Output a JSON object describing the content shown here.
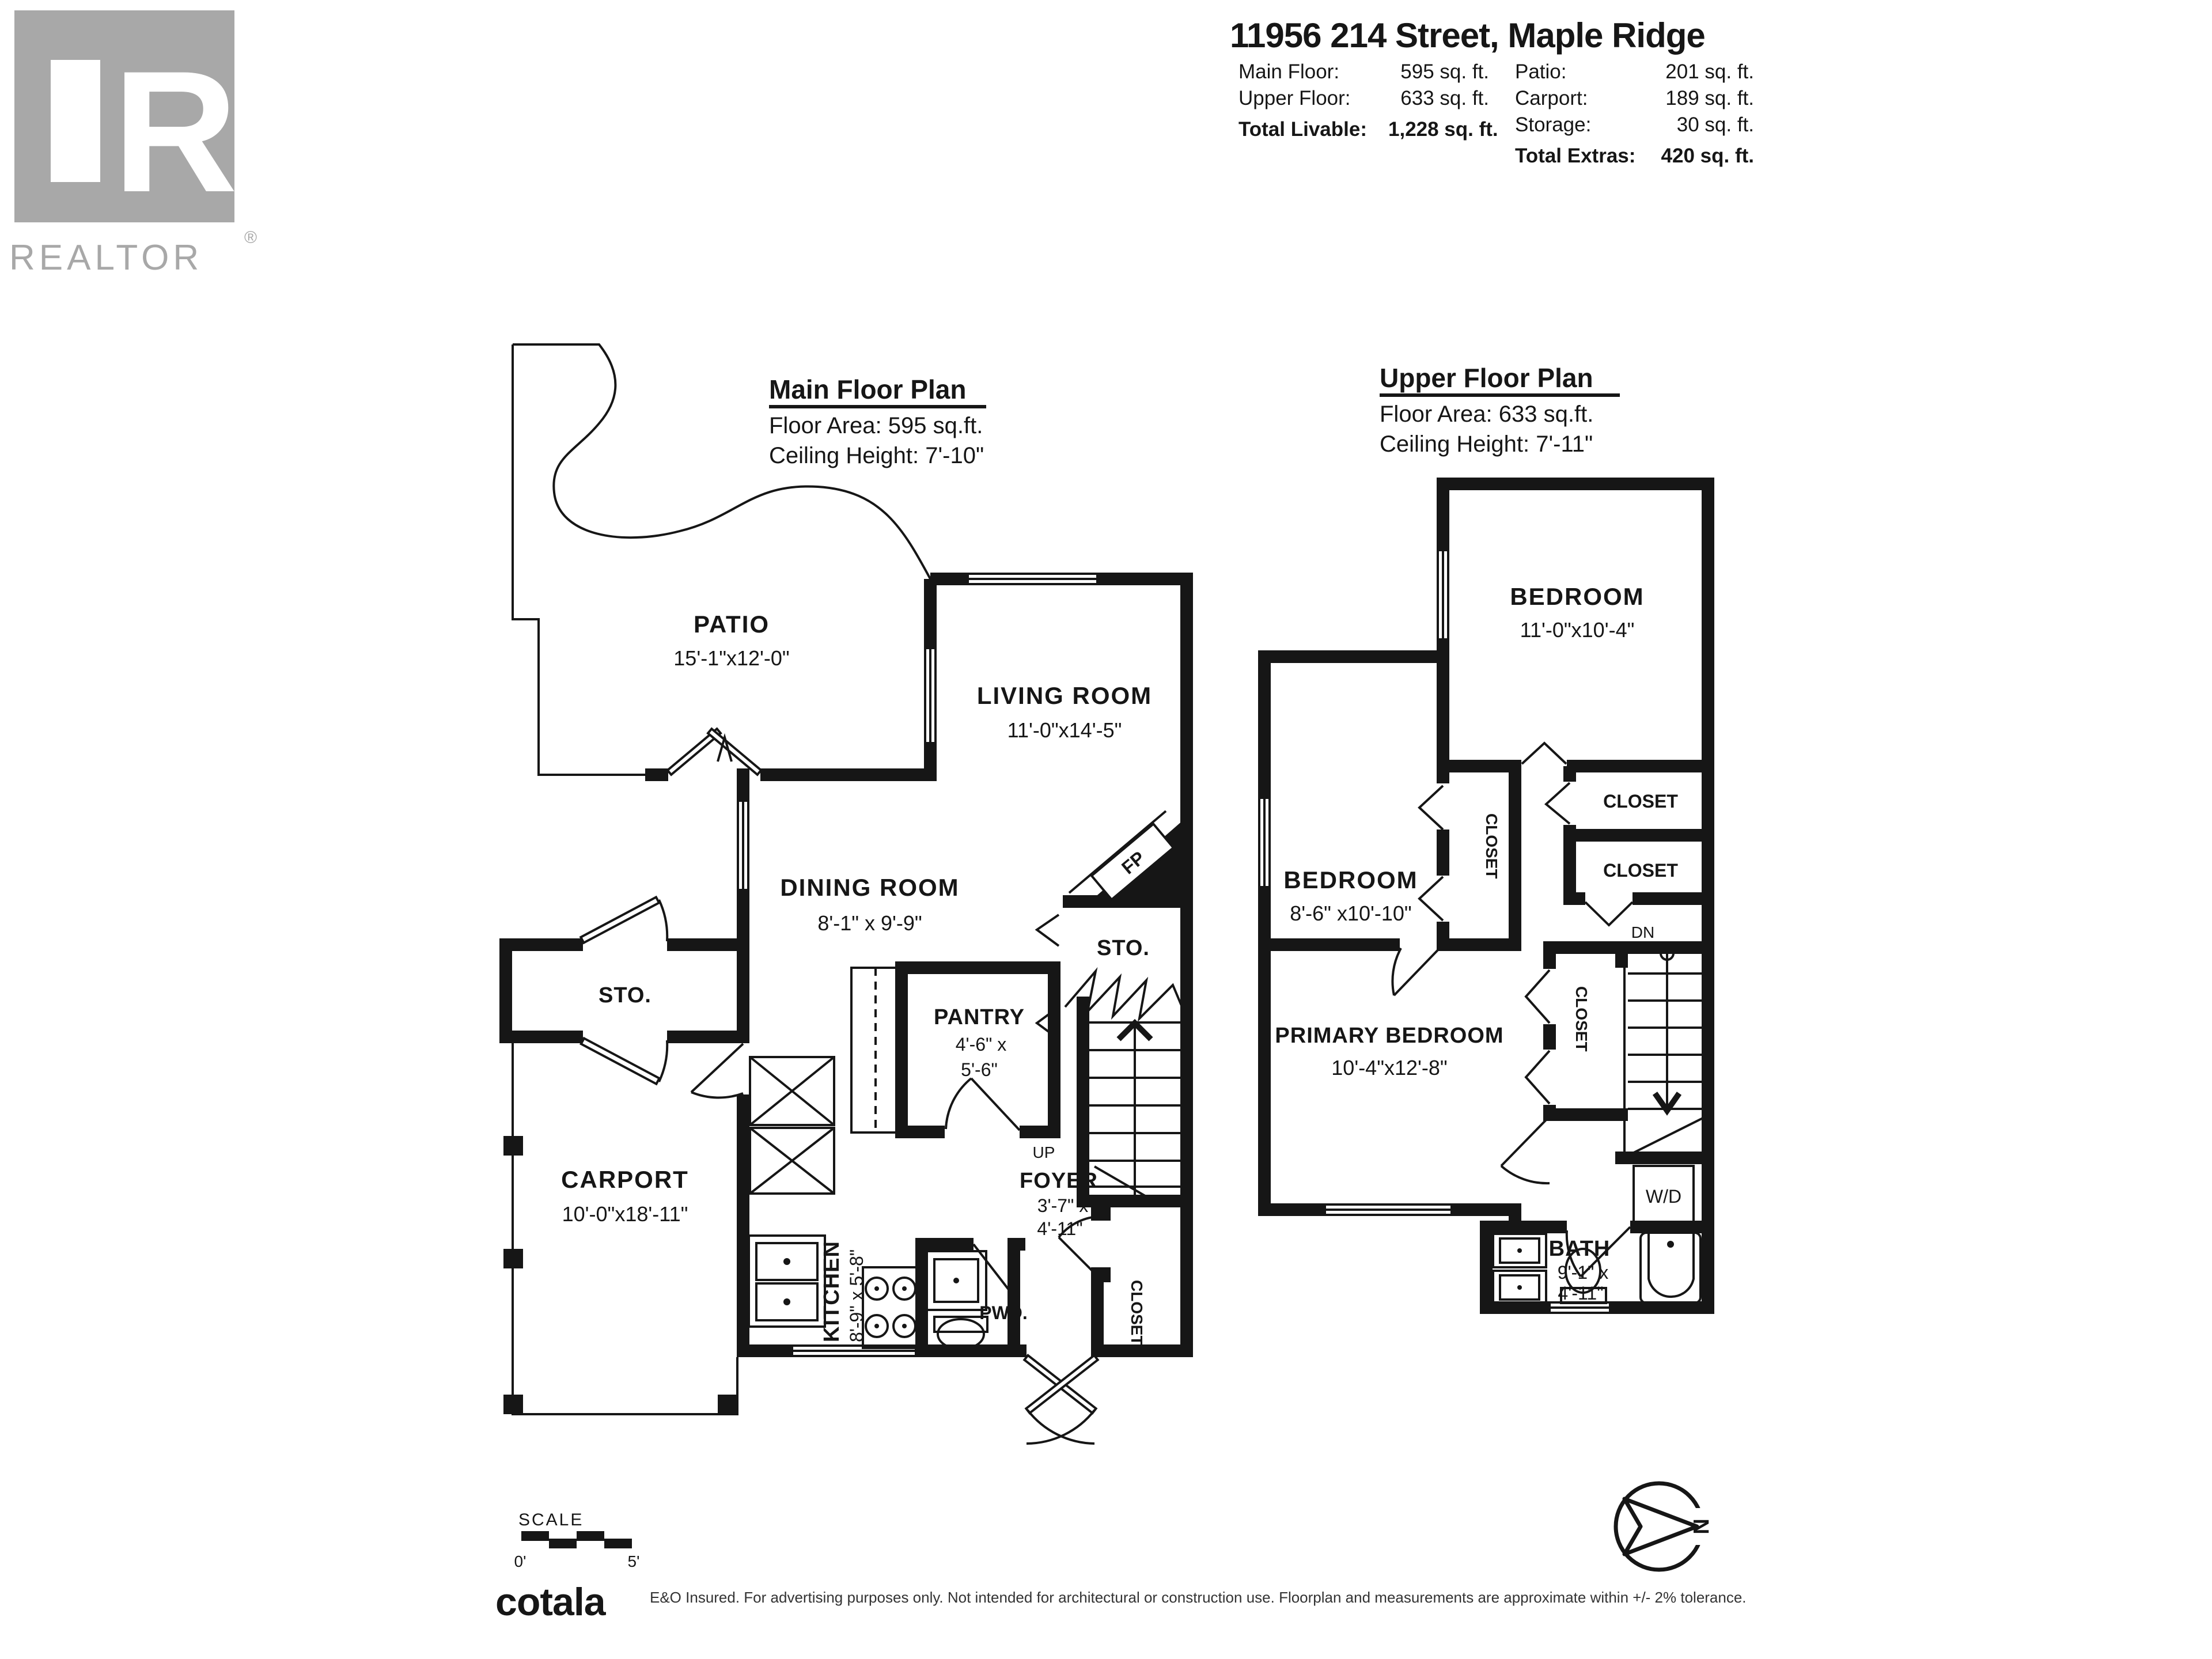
{
  "branding": {
    "logo_r": "R",
    "logo_word": "REALTOR",
    "logo_reg": "®",
    "cotala": "cotala"
  },
  "header": {
    "address": "11956 214 Street, Maple Ridge",
    "rows_left": [
      {
        "label": "Main Floor:",
        "value": "595 sq. ft."
      },
      {
        "label": "Upper Floor:",
        "value": "633 sq. ft."
      }
    ],
    "total_livable_label": "Total Livable:",
    "total_livable_value": "1,228 sq. ft.",
    "rows_right": [
      {
        "label": "Patio:",
        "value": "201 sq. ft."
      },
      {
        "label": "Carport:",
        "value": "189 sq. ft."
      },
      {
        "label": "Storage:",
        "value": "30 sq. ft."
      }
    ],
    "total_extras_label": "Total Extras:",
    "total_extras_value": "420 sq. ft."
  },
  "main_floor": {
    "title": "Main Floor Plan",
    "area": "Floor Area: 595 sq.ft.",
    "ceiling": "Ceiling Height: 7'-10\"",
    "patio": {
      "name": "PATIO",
      "dims": "15'-1\"x12'-0\""
    },
    "living": {
      "name": "LIVING ROOM",
      "dims": "11'-0\"x14'-5\""
    },
    "dining": {
      "name": "DINING ROOM",
      "dims": "8'-1\" x 9'-9\""
    },
    "pantry": {
      "name": "PANTRY",
      "dims1": "4'-6\" x",
      "dims2": "5'-6\""
    },
    "kitchen": {
      "name": "KITCHEN",
      "dims": "8'-9\" x 5'-8\""
    },
    "carport": {
      "name": "CARPORT",
      "dims": "10'-0\"x18'-11\""
    },
    "foyer": {
      "name": "FOYER",
      "dims1": "3'-7\" x",
      "dims2": "4'-11\""
    },
    "sto_left": "STO.",
    "sto_right": "STO.",
    "fp": "FP",
    "up": "UP",
    "pwd": "PWD.",
    "closet": "CLOSET"
  },
  "upper_floor": {
    "title": "Upper Floor Plan",
    "area": "Floor Area: 633 sq.ft.",
    "ceiling": "Ceiling Height: 7'-11\"",
    "bedroom1": {
      "name": "BEDROOM",
      "dims": "11'-0\"x10'-4\""
    },
    "bedroom2": {
      "name": "BEDROOM",
      "dims": "8'-6\" x10'-10\""
    },
    "primary": {
      "name": "PRIMARY BEDROOM",
      "dims": "10'-4\"x12'-8\""
    },
    "bath": {
      "name": "BATH",
      "dims1": "9'-1\" x",
      "dims2": "4'-11\""
    },
    "closet_mid": "CLOSET",
    "closet_r1": "CLOSET",
    "closet_r2": "CLOSET",
    "closet_primary": "CLOSET",
    "dn": "DN",
    "wd": "W/D"
  },
  "footer": {
    "scale_label": "SCALE",
    "scale_zero": "0'",
    "scale_five": "5'",
    "north": "N",
    "disclaimer": "E&O Insured. For advertising purposes only. Not intended for architectural or construction use. Floorplan and measurements are approximate within +/- 2% tolerance."
  }
}
